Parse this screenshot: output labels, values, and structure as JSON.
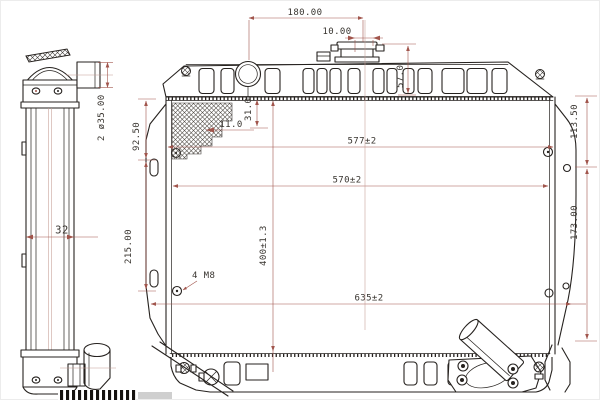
{
  "drawing": {
    "title": "radiator-engineering-drawing",
    "side_view": {
      "inlet_diameter": "2 ø35.00",
      "core_depth": "32"
    },
    "front_view": {
      "filler_to_cap": "180.00",
      "cap_offset": "10.00",
      "cap_height": "57.0",
      "neck_to_core": "31.0",
      "fin_depth": "11.0",
      "left_top_span": "92.50",
      "left_hole_span": "215.00",
      "right_top_span": "113.50",
      "right_hole_span": "173.00",
      "core_width_outer": "577±2",
      "core_width_inner": "570±2",
      "core_height": "400±1.3",
      "overall_width": "635±2",
      "mounting_holes": "4 M8"
    },
    "colors": {
      "background": "#ffffff",
      "outline": "#26221f",
      "dimension_lines": "#a1554c",
      "text": "#38342f"
    }
  }
}
